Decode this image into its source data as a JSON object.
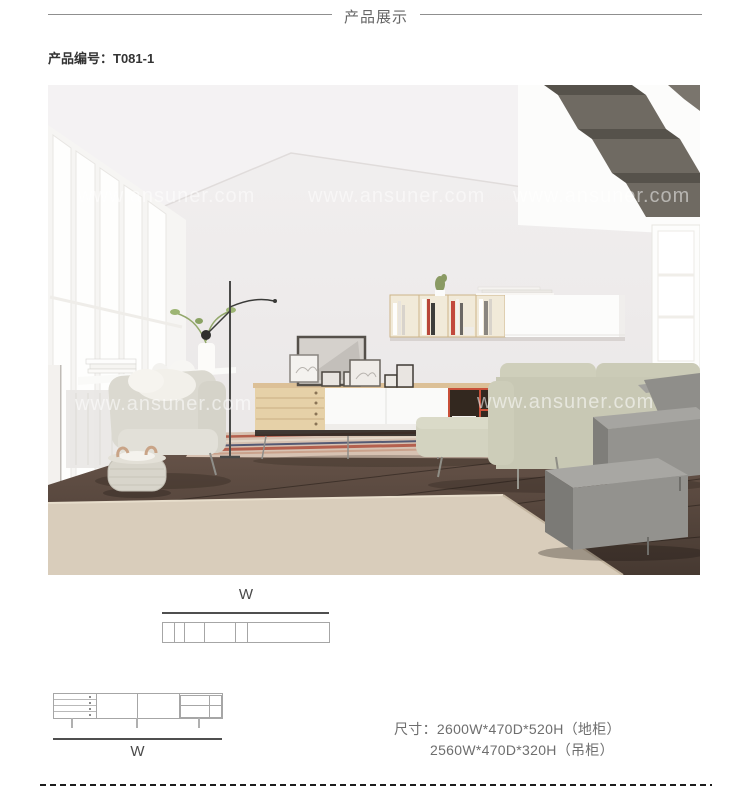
{
  "header": {
    "title": "产品展示"
  },
  "product": {
    "code": "产品编号：T081-1"
  },
  "photo": {
    "watermark": "www.ansuner.com"
  },
  "drawings": {
    "top_view": {
      "dim_label": "W"
    },
    "front_view": {
      "dim_label": "W"
    }
  },
  "dimensions": {
    "label": "尺寸：",
    "line1": "2600W*470D*520H（地柜）",
    "line2": "2560W*470D*320H（吊柜）"
  },
  "colors": {
    "accent_shelf_red": "#c94f38",
    "cabinet_wood": "#e6d1a8",
    "sofa_fabric": "#c8c8b4",
    "floor_wood": "#5a4a40",
    "stair_gray": "#9c9b97",
    "rule_gray": "#8f8f8f",
    "text_dark": "#333333",
    "text_gray": "#6e6e6e"
  }
}
